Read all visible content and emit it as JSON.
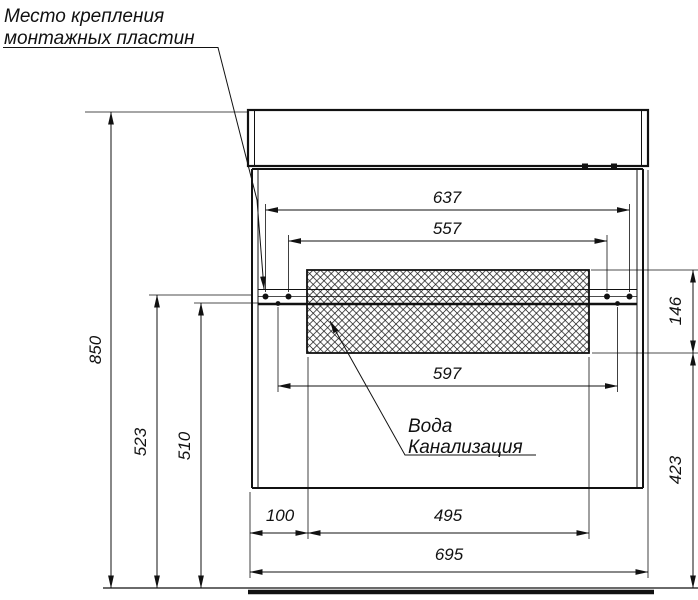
{
  "figure": {
    "background_color": "#ffffff",
    "line_color": "#111111",
    "notes": {
      "mounting_plates": {
        "line1": "Место крепления",
        "line2": "монтажных пластин"
      },
      "utilities": {
        "line1": "Вода",
        "line2": "Канализация"
      }
    },
    "dimensions_mm": {
      "outer_plate_span": "637",
      "inner_plate_span": "557",
      "plate_center_span": "597",
      "service_zone_height": "146",
      "below_zone_height": "423",
      "total_height": "850",
      "rail_upper_height": "523",
      "rail_lower_height": "510",
      "left_inset": "100",
      "service_zone_width": "495",
      "total_width": "695"
    }
  }
}
